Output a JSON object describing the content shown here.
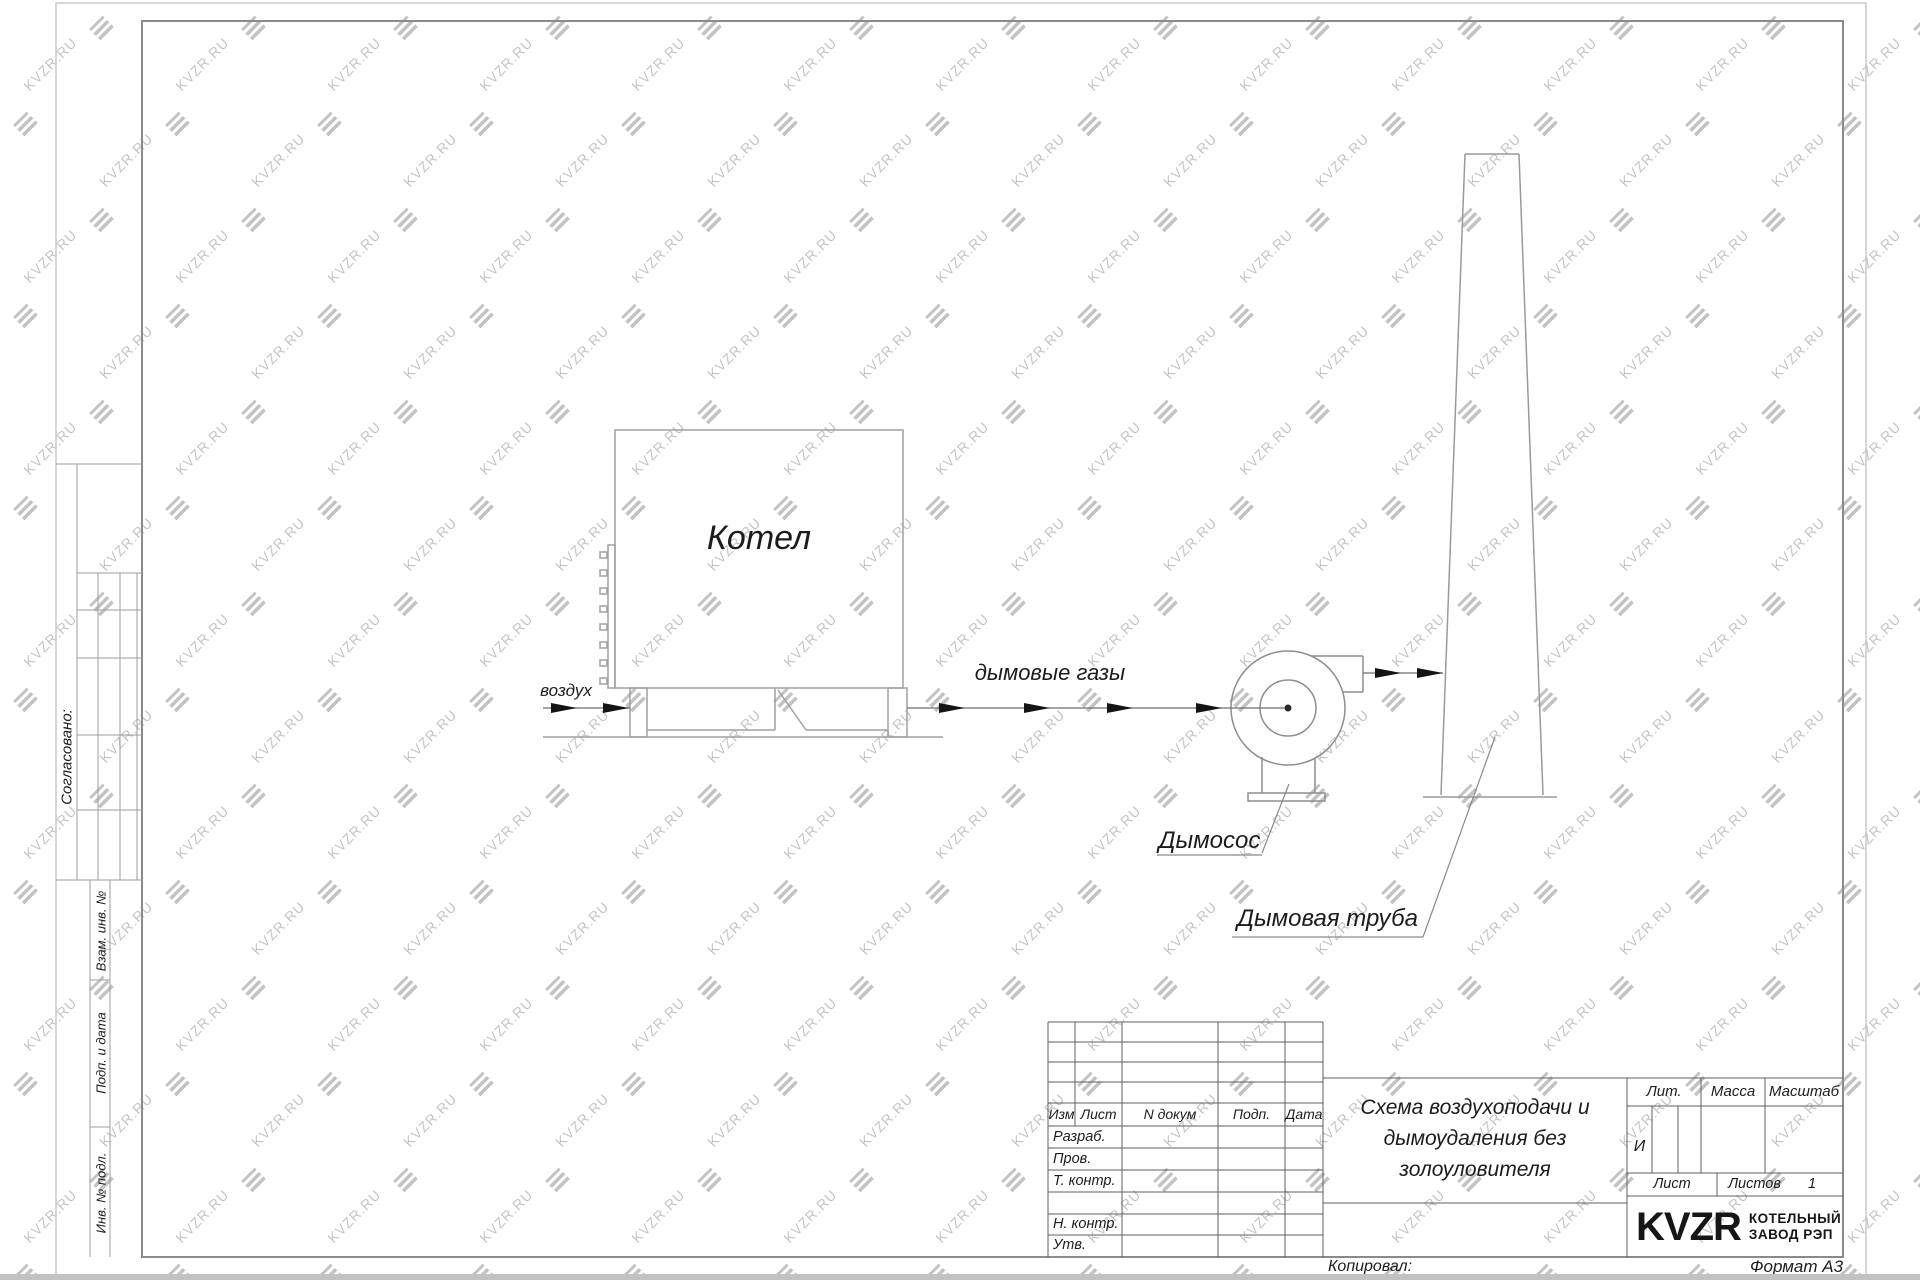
{
  "watermark": {
    "text": "KVZR.RU"
  },
  "margin": {
    "agreed": "Согласовано:",
    "vzam": "Взам. инв. №",
    "podp_data": "Подп. и дата",
    "inv_podl": "Инв. № подл."
  },
  "diagram": {
    "boiler": "Котел",
    "air": "воздух",
    "flue_gases": "дымовые газы",
    "fan": "Дымосос",
    "chimney": "Дымовая труба"
  },
  "titleblock": {
    "header": [
      "Изм",
      "Лист",
      "N докум",
      "Подп.",
      "Дата"
    ],
    "rows": [
      "Разраб.",
      "Пров.",
      "Т. контр.",
      "Н. контр.",
      "Утв."
    ],
    "title_lines": [
      "Схема воздухоподачи и",
      "дымоудаления без",
      "золоуловителя"
    ],
    "lit_header": "Лит.",
    "mass_header": "Масса",
    "scale_header": "Масштаб",
    "lit_value": "И",
    "sheet_label": "Лист",
    "sheets_label": "Листов",
    "sheets_value": "1",
    "brand": "KVZR",
    "company_line1": "КОТЕЛЬНЫЙ",
    "company_line2": "ЗАВОД РЭП",
    "copied_label": "Копировал:",
    "format_label": "Формат А3"
  }
}
